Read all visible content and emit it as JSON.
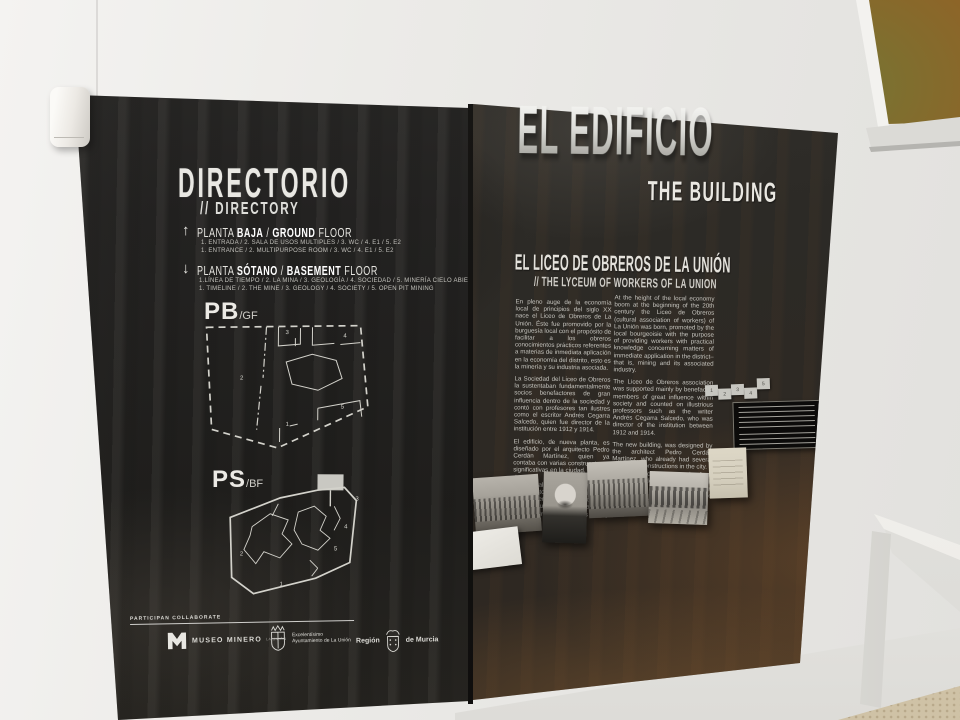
{
  "colors": {
    "panel_dark": "#242321",
    "panel_rust": "#3a3129",
    "text_light": "#e8e7e2",
    "wall": "#ecebe8"
  },
  "left_panel": {
    "title": "DIRECTORIO",
    "subtitle": "// DIRECTORY",
    "ground": {
      "arrow": "↑",
      "p0": "PLANTA ",
      "p1": "BAJA",
      "p2": " / ",
      "p3": "GROUND",
      "p4": " FLOOR",
      "es": "1. ENTRADA / 2. SALA DE USOS MULTIPLES / 3. WC / 4. E1 / 5. E2",
      "en": "1. ENTRANCE / 2. MULTIPURPOSE ROOM / 3. WC / 4. E1 / 5. E2"
    },
    "basement": {
      "arrow": "↓",
      "p0": "PLANTA ",
      "p1": "SÓTANO",
      "p2": " / ",
      "p3": "BASEMENT",
      "p4": " FLOOR",
      "es": "1.LÍNEA DE TIEMPO / 2. LA MINA / 3. GEOLOGÍA / 4. SOCIEDAD / 5. MINERÍA CIELO ABIERTO",
      "en": "1. TIMELINE / 2. THE MINE / 3. GEOLOGY / 4. SOCIETY / 5. OPEN PIT MINING"
    },
    "plan_pb": {
      "big": "PB",
      "small": "/GF",
      "r1": "1",
      "r2": "2",
      "r3": "3",
      "r4": "4",
      "r5": "5"
    },
    "plan_ps": {
      "big": "PS",
      "small": "/BF",
      "r1": "1",
      "r2": "2",
      "r3": "3",
      "r4": "4",
      "r5": "5"
    },
    "participate": "PARTICIPAN COLLABORATE",
    "logo_museo": {
      "name": "MUSEO MINERO",
      "sub": "LA UNIÓN"
    },
    "logo_ayto": {
      "line1": "Excelentísimo",
      "line2": "Ayuntamiento de La Unión"
    },
    "logo_region": {
      "left": "Región",
      "right": "de Murcia"
    }
  },
  "right_panel": {
    "title": "EL EDIFICIO",
    "title_en": "THE BUILDING",
    "heading_es": "EL LICEO DE OBREROS DE LA UNIÓN",
    "heading_en": "// THE LYCEUM OF WORKERS OF LA UNION",
    "body_es": [
      "En pleno auge de la economía local de principios del siglo XX nace el Liceo de Obreros de La Unión. Éste fue promovido por la burguesía local con el propósito de facilitar a los obreros conocimientos prácticos referentes a materias de inmediata aplicación en la economía del distrito, esto es la minería y su industria asociada.",
      "La Sociedad del Liceo de Obreros la sustentaban fundamentalmente socios benefactores de gran influencia dentro de la sociedad y contó con profesores tan ilustres como el escritor Andrés Cegarra Salcedo, quien fue director de la institución entre 1912 y 1914.",
      "El edificio, de nueva planta, es diseñado por el arquitecto Pedro Cerdán Martínez, quien ya contaba con varias construcciones significativas en la ciudad. Se trata de un complejo de planta trapezoidal relacionado con el movimiento premodernista, sobre cuya puerta principal podemos observar una talla en relieve con los emblemas de las Bellas Artes y la Minería."
    ],
    "body_en": [
      "At the height of the local economy boom at the beginning of the 20th century the Liceo de Obreros (cultural association of workers) of La Unión was born, promoted by the local bourgeoisie with the purpose of providing workers with practical knowledge concerning matters of immediate application in the district– that is, mining and its associated industry.",
      "The Liceo de Obreros association was supported mainly by benefactor members of great influence within society and counted on illustrious professors such as the writer Andrés Cegarra Salcedo, who was director of the institution between 1912 and 1914.",
      "The new building, was designed by the architect Pedro Cerdán Martínez, who already had several significant constructions in the city. It is a trapezoidal plant complex from the pre-modernist movement, on whose main door we can see an embossed carving with the emblems of Fine Arts and Mining."
    ],
    "minimap": [
      "1",
      "2",
      "3",
      "4",
      "5"
    ]
  }
}
